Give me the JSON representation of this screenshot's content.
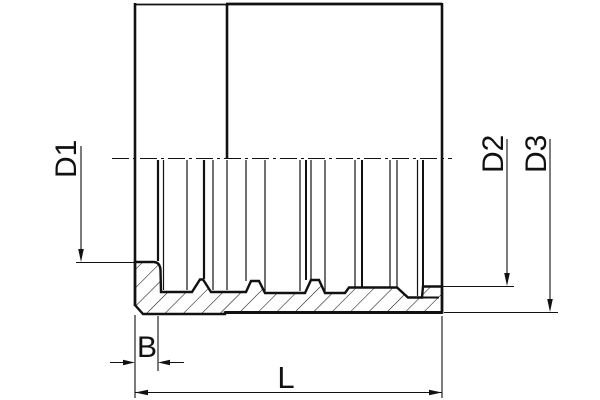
{
  "drawing": {
    "description": "Technical section drawing of a hydraulic hose ferrule sleeve",
    "colors": {
      "line": "#111111",
      "background": "#ffffff"
    },
    "labels": {
      "d1": "D1",
      "d2": "D2",
      "d3": "D3",
      "b": "B",
      "l": "L"
    }
  }
}
